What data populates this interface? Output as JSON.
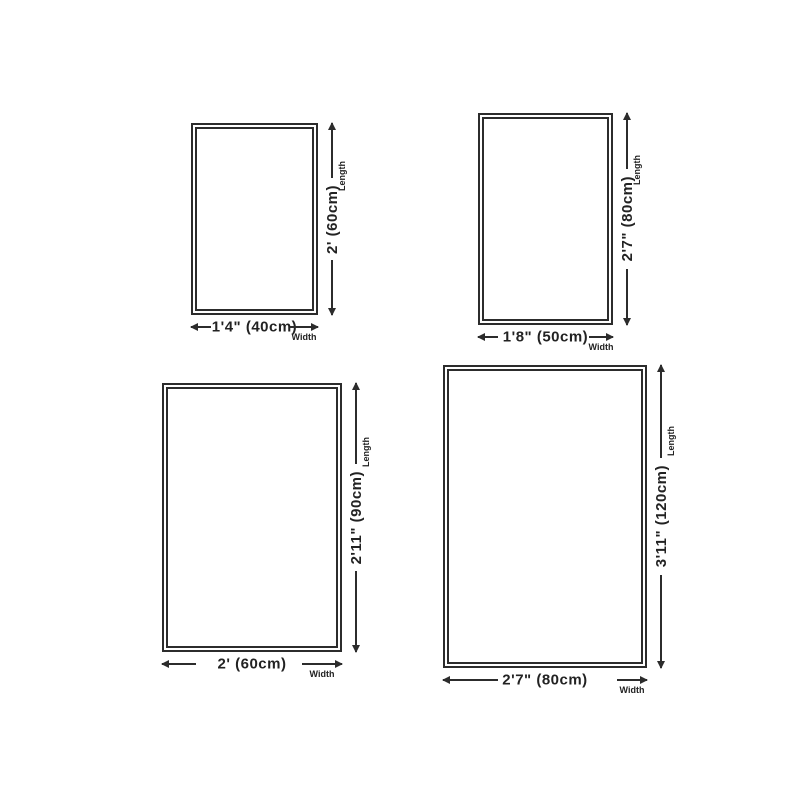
{
  "colors": {
    "line": "#2c2c2c",
    "text": "#222222",
    "background": "#ffffff"
  },
  "diagrams": [
    {
      "id": "size-40x60",
      "width_label": "1'4\" (40cm)",
      "length_label": "2' (60cm)",
      "width_caption": "Width",
      "length_caption": "Length"
    },
    {
      "id": "size-50x80",
      "width_label": "1'8\" (50cm)",
      "length_label": "2'7\" (80cm)",
      "width_caption": "Width",
      "length_caption": "Length"
    },
    {
      "id": "size-60x90",
      "width_label": "2' (60cm)",
      "length_label": "2'11\" (90cm)",
      "width_caption": "Width",
      "length_caption": "Length"
    },
    {
      "id": "size-80x120",
      "width_label": "2'7\" (80cm)",
      "length_label": "3'11\" (120cm)",
      "width_caption": "Width",
      "length_caption": "Length"
    }
  ]
}
